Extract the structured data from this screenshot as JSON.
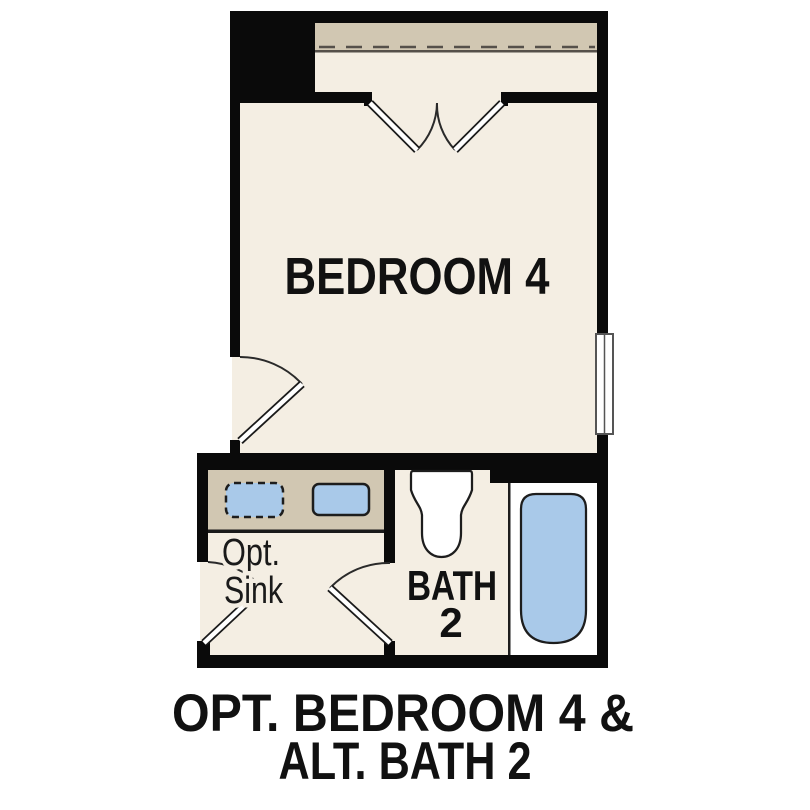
{
  "labels": {
    "bedroom": "BEDROOM 4",
    "bath_line1": "BATH",
    "bath_line2": "2",
    "sink_line1": "Opt.",
    "sink_line2": "Sink"
  },
  "caption": {
    "line1": "OPT. BEDROOM 4 &",
    "line2": "ALT. BATH 2"
  },
  "colors": {
    "background": "#ffffff",
    "wall": "#0a0a0a",
    "floor": "#f4eee3",
    "counter": "#d1c7b2",
    "fixture_blue": "#a9c9e9",
    "outline": "#1d1d1d",
    "shelf_line": "#55504a",
    "alcove_white": "#ffffff"
  },
  "fixtures": {
    "closet": "shelf-with-dashed-rod",
    "doors": [
      "double-door",
      "entry-door",
      "vanity-door",
      "bath-door"
    ],
    "window": "double-pane-window",
    "vanity": "counter-with-two-sinks",
    "optional_sink_style": "dashed-outline",
    "bath": [
      "toilet",
      "bathtub"
    ]
  }
}
